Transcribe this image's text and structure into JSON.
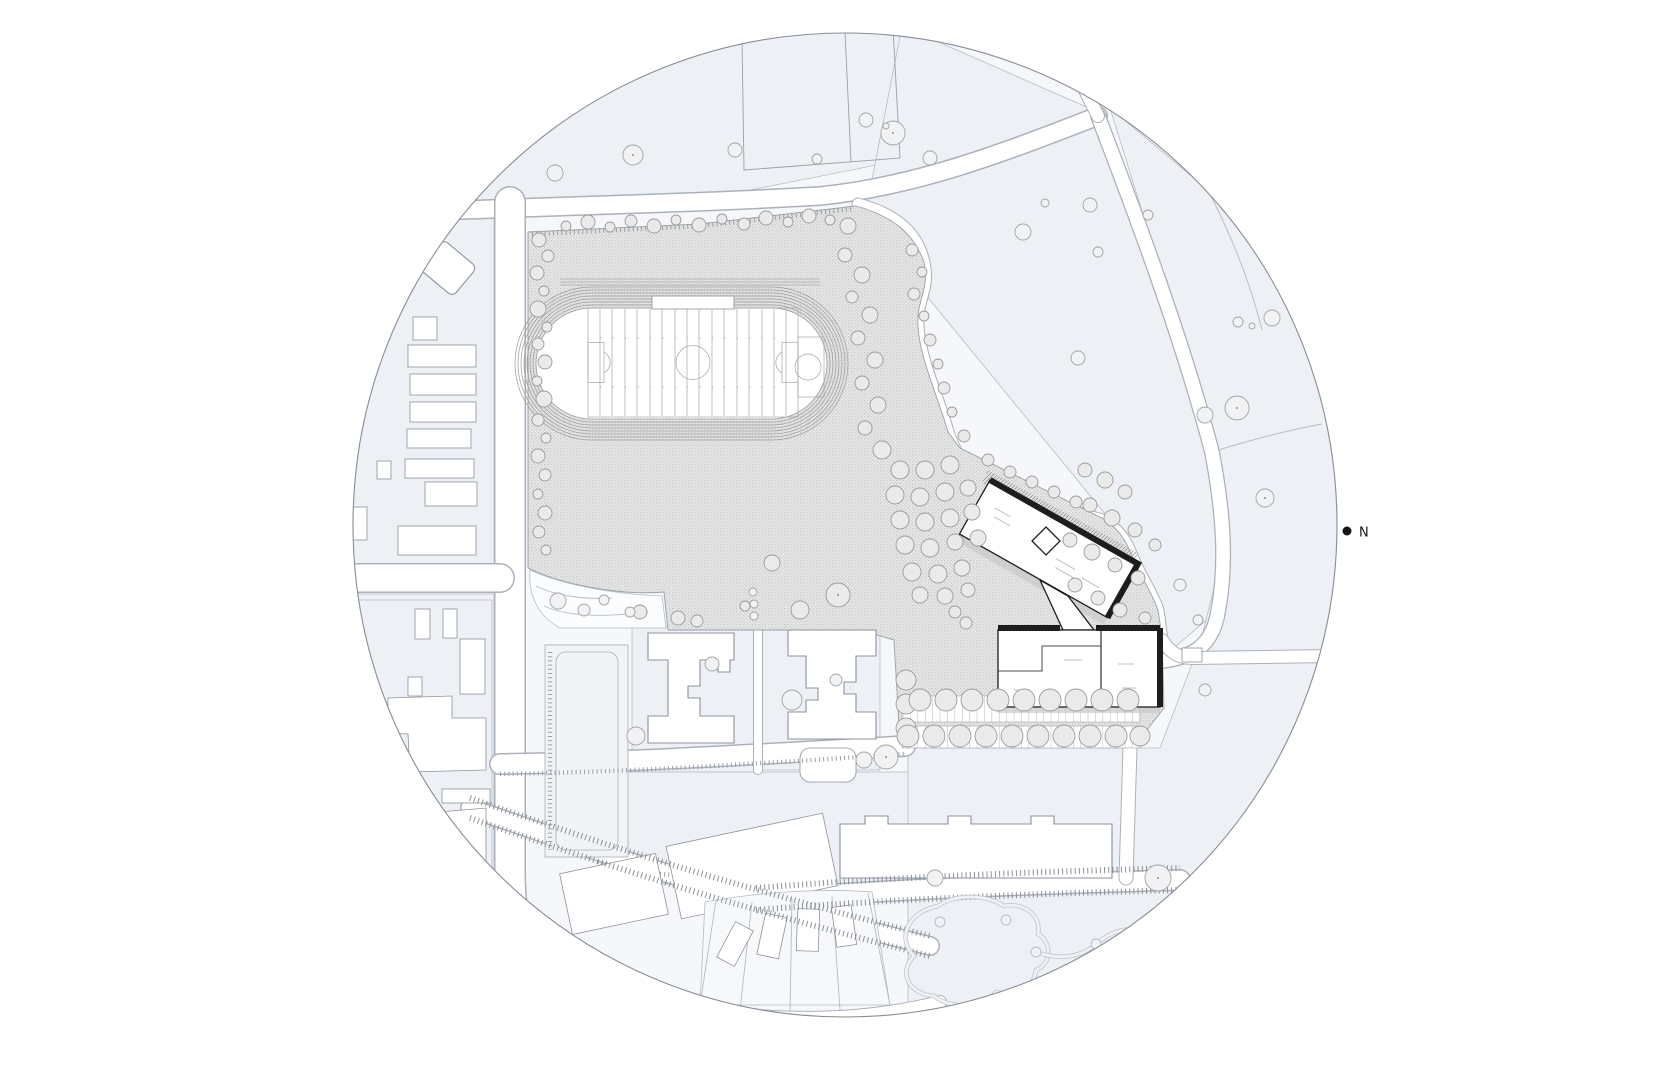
{
  "document": {
    "kind": "architectural-site-plan",
    "crop": "circular"
  },
  "north_indicator": {
    "label": "N"
  },
  "colors": {
    "paper": "#ffffff",
    "parcel": "#edf0f5",
    "parcel-line": "#b6bcc6",
    "road-line": "#abb1b9",
    "hatch-bg": "#e7e8e8",
    "hatch-dot": "#bdbdbd",
    "context-line": "#8d939b",
    "main-line": "#1d1d1d",
    "tree-line": "#a3a3a3",
    "shadow": "#c9c9c9",
    "ink": "#151515"
  },
  "features": [
    "site-boundary-circle",
    "campus-plaza-hatched",
    "running-track",
    "sports-field",
    "school-building-north",
    "school-building-south",
    "building-connector",
    "parking-lot-with-trees",
    "h-shaped-context-buildings",
    "long-residential-building",
    "context-block-west",
    "park-path-loops",
    "street-network",
    "tree-canopies",
    "north-indicator"
  ]
}
